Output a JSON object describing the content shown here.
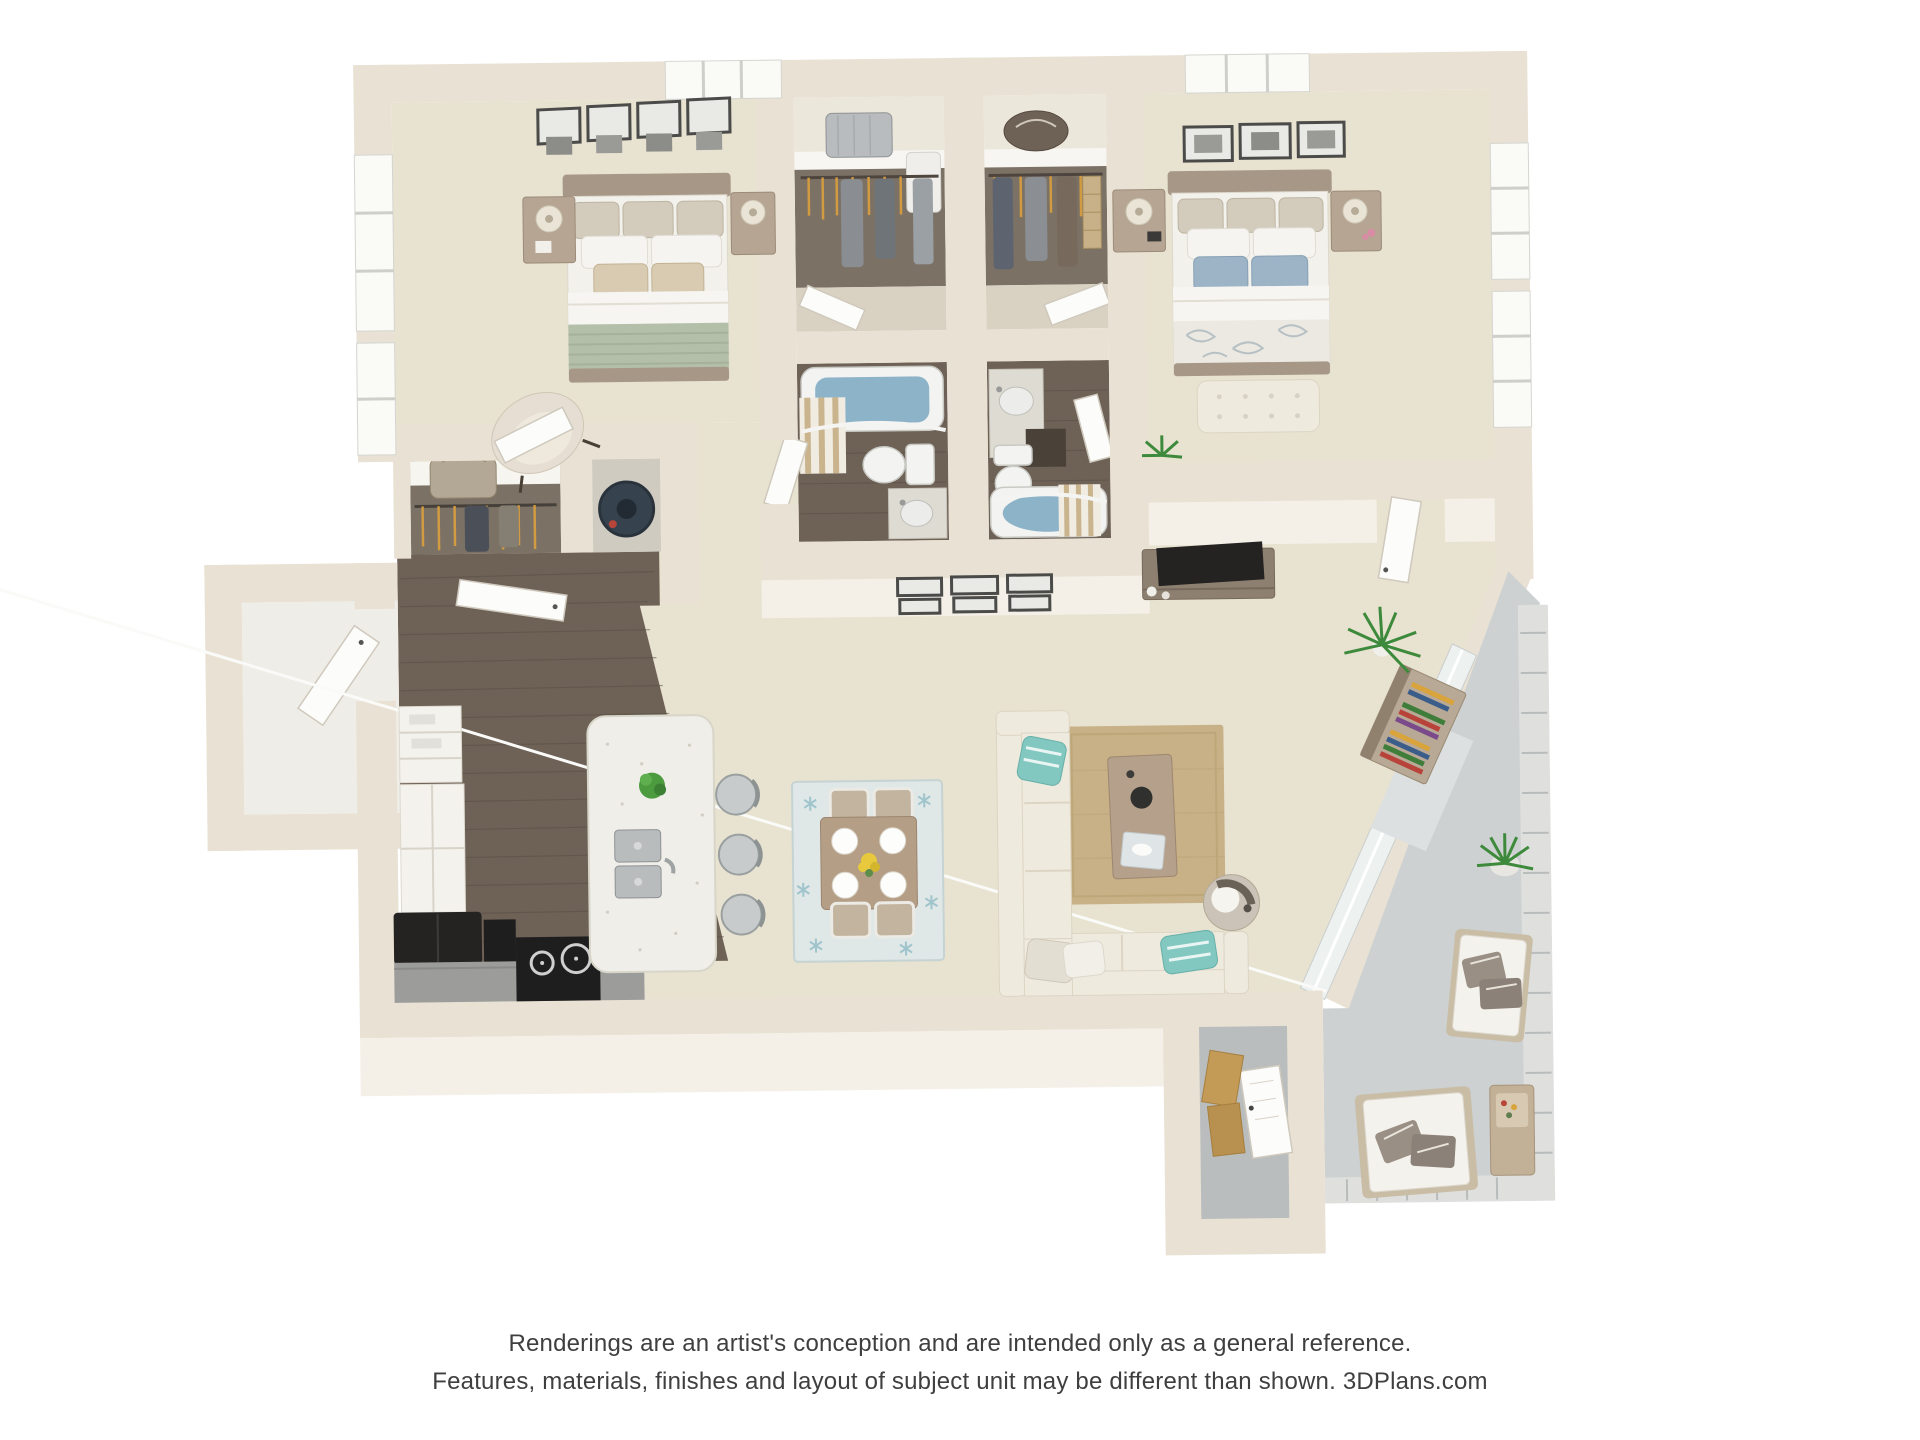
{
  "disclaimer": {
    "line1": "Renderings are an artist's conception and are intended only as a general reference.",
    "line2": "Features, materials, finishes and layout of subject unit may be different than shown. 3DPlans.com"
  },
  "colors": {
    "background": "#ffffff",
    "text": "#3f3f3f",
    "wall": "#e9e2d4",
    "wall_face": "#f4f0e7",
    "carpet": "#e8e2d0",
    "wood_floor": "#6e6156",
    "balcony_concrete": "#cdd1d1",
    "storage_concrete": "#b9bdbd",
    "tub_water": "#8db3c9",
    "sage_blanket": "#b4bfa9",
    "blue_pillow": "#9cb4c6",
    "teal_pillow": "#82c7c0",
    "jute_rug": "#c8b187",
    "dining_rug": "#dfe7e7",
    "island_quartz": "#efeee8",
    "granite_counter": "#dedbd2",
    "kitchen_counter": "#9c9c9a",
    "appliance_black": "#242322",
    "sofa_cream": "#efeade",
    "door_white": "#fcfcfa",
    "railing": "#dfe0de",
    "water_heater_navy": "#36434f",
    "hanger_orange": "#d29a41",
    "plant_green": "#3e8a3c",
    "bed_frame_taupe": "#a79786",
    "picture_frame": "#4b4b49"
  }
}
